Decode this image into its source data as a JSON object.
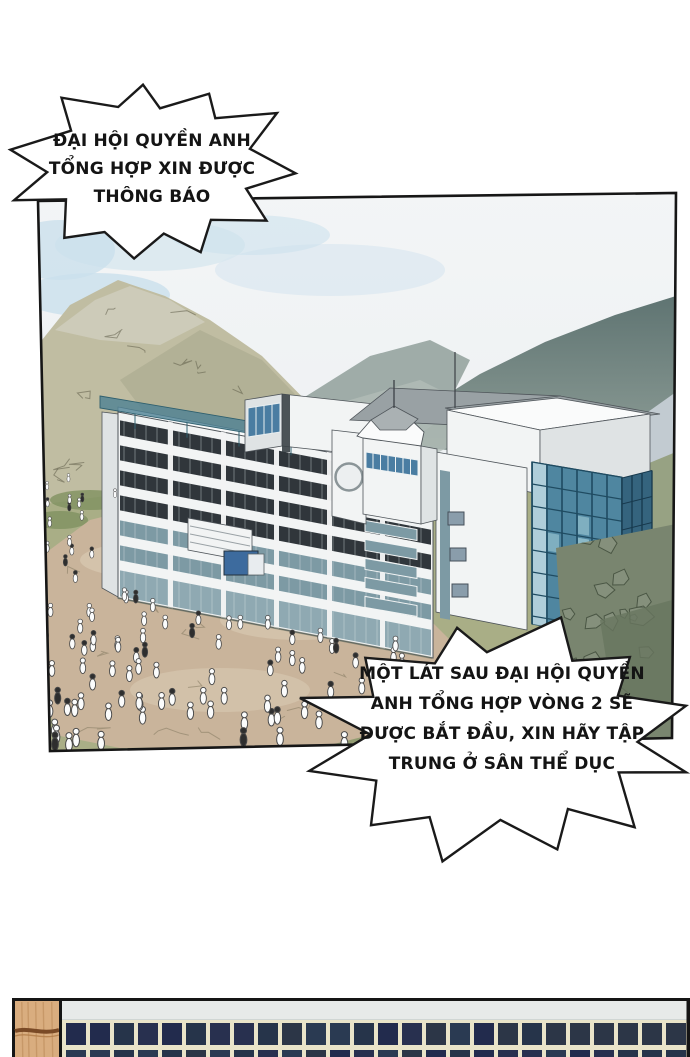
{
  "page": {
    "type": "webtoon comic page",
    "background": "#ffffff",
    "scene_description": "Aerial view of a school campus building in a mountain valley with a crowd of students gathering on the grounds"
  },
  "speech_bubbles": [
    {
      "name": "announcement-bubble-top",
      "shape": "starburst",
      "fill": "#ffffff",
      "stroke": "#1a1a1a",
      "lines": [
        "ĐẠI HỘI QUYỀN ANH",
        "TỔNG HỢP XIN ĐƯỢC",
        "THÔNG BÁO"
      ]
    },
    {
      "name": "announcement-bubble-bottom",
      "shape": "starburst",
      "fill": "#ffffff",
      "stroke": "#1a1a1a",
      "lines": [
        "MỘT LÁT SAU ĐẠI HỘI QUYỀN",
        "ANH TỔNG HỢP VÒNG 2 SẼ",
        "ĐƯỢC BẮT ĐẦU, XIN HÃY TẬP",
        "TRUNG Ở SÂN THỂ DỤC"
      ]
    }
  ],
  "panel": {
    "border_color": "#161616",
    "colors": {
      "skyTop": "#f3f5f6",
      "sky": "#edf0f2",
      "cloud": "#d9e7ef",
      "cloudBlue": "#cbe0ec",
      "ridgeTop": "#5f7472",
      "ridgeBottom": "#93a29b",
      "ridgeMid": "#9aa8a3",
      "ridgeFarLight": "#b3beb8",
      "mountain": "#c0bda2",
      "mountainTop": "#cdcbb9",
      "mountainShadow": "#a9a88d",
      "sketch": "#5e5c48",
      "grass": "#a9ae86",
      "grassDark": "#8f9a6e",
      "treeline": "#7f9160",
      "dirt": "#c9b49b",
      "dirtLight": "#d8c9b2",
      "dirtLine": "#8b7f66",
      "rockLight": "#c2cbd1",
      "rockLine": "#6f7d85",
      "slopeGreen": "#97a283",
      "rockDark": "#79856f",
      "rockDarkLine": "#4a5644",
      "stoneLight": "#a3ad9c",
      "white": "#f2f4f4",
      "whiteShade": "#dfe3e4",
      "whiteBright": "#fafbfb",
      "roofGray": "#99a1a4",
      "outline": "#4f555a",
      "windowDark": "#30363b",
      "windowTeal": "#7d9aa4",
      "mullion": "#dfe8ea",
      "glassBlue": "#4a7da2",
      "glassLight": "#b9d6e0",
      "curtainBlue": "#4f86a0",
      "curtainSide": "#35647e",
      "curtainLine": "#1f4b61",
      "canopy": "#4c8193",
      "kioskBlue": "#3d6b9e",
      "crowdFill": "#fbfcfc",
      "crowdLine": "#4a4a4a",
      "crowdDark": "#2e2e2e"
    }
  },
  "bottom_panel": {
    "description": "top sliver of next panel: dark tiled wall with wooden beam",
    "colors": {
      "border": "#151515",
      "wood": "#d9ad7f",
      "woodGrain": "#c0905f",
      "woodSeam": "#7a4a26",
      "woodSeamLight": "#b07c49",
      "band": "#e7eae9",
      "bandEdge": "#b9c1bf",
      "grout": "#e9e4c9",
      "tiles": [
        "#222b4d",
        "#28304f",
        "#2c3647",
        "#26344a",
        "#2a3a52"
      ]
    }
  }
}
